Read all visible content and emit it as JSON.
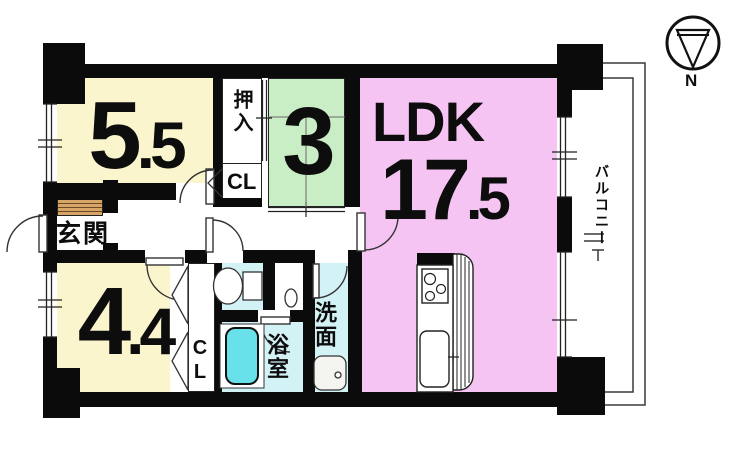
{
  "floorplan": {
    "compass": {
      "north_label": "N"
    },
    "rooms": {
      "bedroom1": {
        "size_int": "5",
        "size_frac": ".5"
      },
      "bedroom2": {
        "size": "3"
      },
      "bedroom3": {
        "size_int": "4",
        "size_frac": ".4"
      },
      "ldk": {
        "label": "LDK",
        "size_int": "17",
        "size_frac": ".5"
      },
      "oshiire": {
        "label": "押入"
      },
      "closet_upper": {
        "label": "CL"
      },
      "closet_lower": {
        "label": "CL"
      },
      "genkan": {
        "label": "玄関"
      },
      "bathroom": {
        "label": "浴室"
      },
      "washroom": {
        "label": "洗面"
      },
      "balcony": {
        "label": "バルコニー"
      }
    },
    "colors": {
      "tatami_yellow": "#faf5cc",
      "bedroom_green": "#c9eec6",
      "ldk_pink": "#f5c4f2",
      "wet_area_cyan": "#d3f2f5",
      "washer_white": "#ffffff",
      "bathtub_cyan": "#68e1ea",
      "entry_mat_tan": "#d8a569",
      "wall_black": "#0b0b0b"
    }
  }
}
